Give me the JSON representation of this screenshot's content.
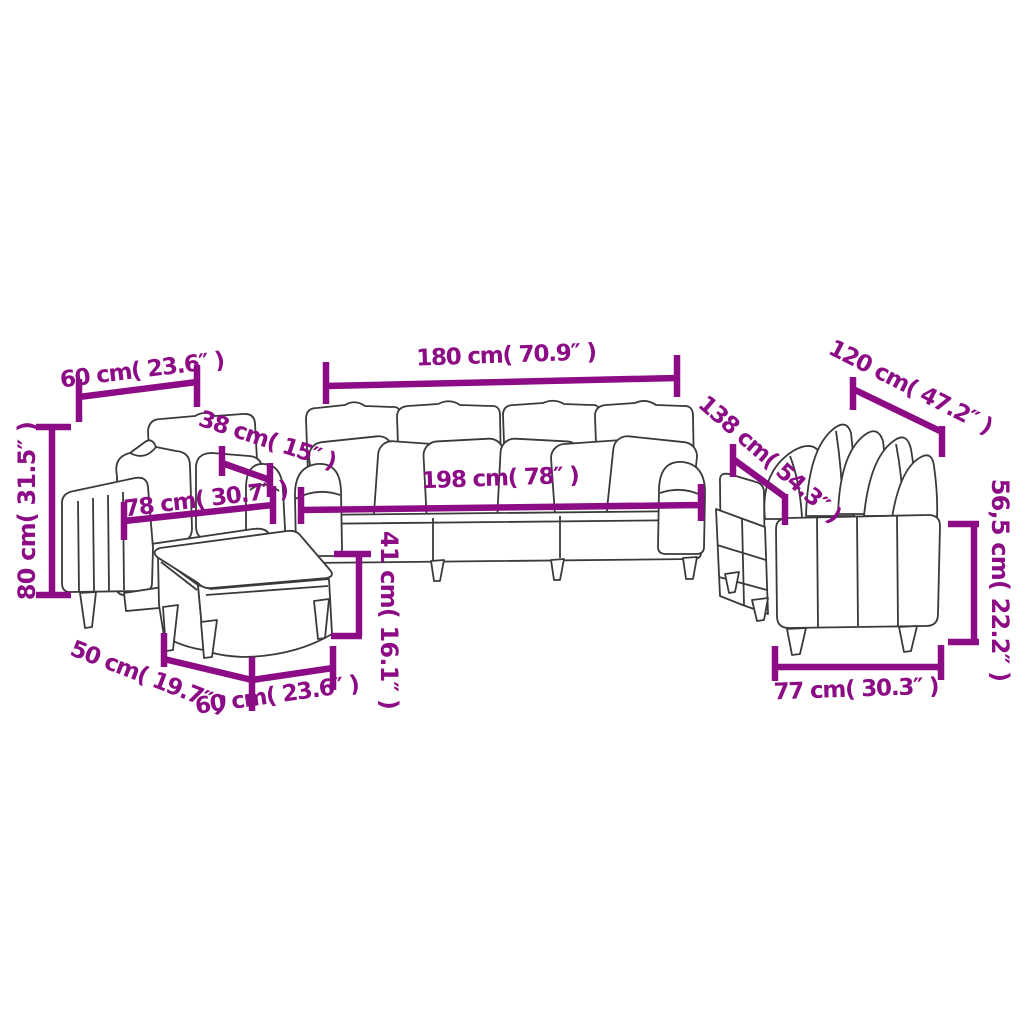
{
  "diagram": {
    "background": "#ffffff",
    "dimension_color": "#8C0C85",
    "line_art_color": "#3a3a3a",
    "labels": {
      "armchair_back_width": "60 cm( 23.6″ )",
      "armchair_height": "80 cm( 31.5″ )",
      "armchair_armrest": "38 cm( 15″ )",
      "armchair_width": "78 cm( 30.7″ )",
      "footstool_depth": "50 cm( 19.7″ )",
      "footstool_width": "60 cm( 23.6″ )",
      "footstool_height": "41 cm( 16.1″ )",
      "sofa3_back_width": "180 cm( 70.9″ )",
      "sofa3_total_width": "198 cm( 78″ )",
      "sofa2_back_width": "120 cm( 47.2″ )",
      "sofa2_total_width": "138 cm( 54.3″ )",
      "sofa2_height": "56,5 cm( 22.2″ )",
      "sofa2_depth": "77 cm( 30.3″ )"
    }
  }
}
